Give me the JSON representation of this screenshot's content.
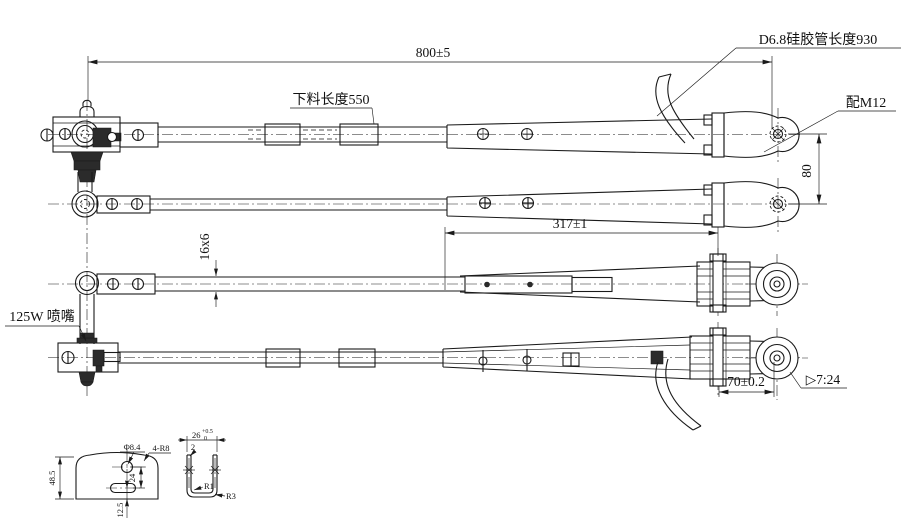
{
  "drawing": {
    "type": "engineering-cad-drawing",
    "subject": "wiper arm assembly, four views with detail parts",
    "colors": {
      "line": "#1a1a1a",
      "background": "#ffffff"
    }
  },
  "labels": {
    "dim_800": "800±5",
    "silicone_tube": "D6.8硅胶管长度930",
    "blank_length": "下料长度550",
    "fit_m12": "配M12",
    "dim_80": "80",
    "dim_317": "317±1",
    "section_16x6": "16x6",
    "nozzle": "125W 喷嘴",
    "dim_70": "70±0.2",
    "taper_ratio": "▷7:24",
    "plate": {
      "height": "48.5",
      "hole_dia": "Φ8.4",
      "corner_radius": "4-R8",
      "dim_24": "24",
      "dim_12_5": "12.5"
    },
    "channel": {
      "width": "26",
      "tol_upper": "+0.5",
      "tol_lower": "0",
      "thickness": "2",
      "inner_radius": "R1",
      "outer_radius": "R3"
    }
  }
}
